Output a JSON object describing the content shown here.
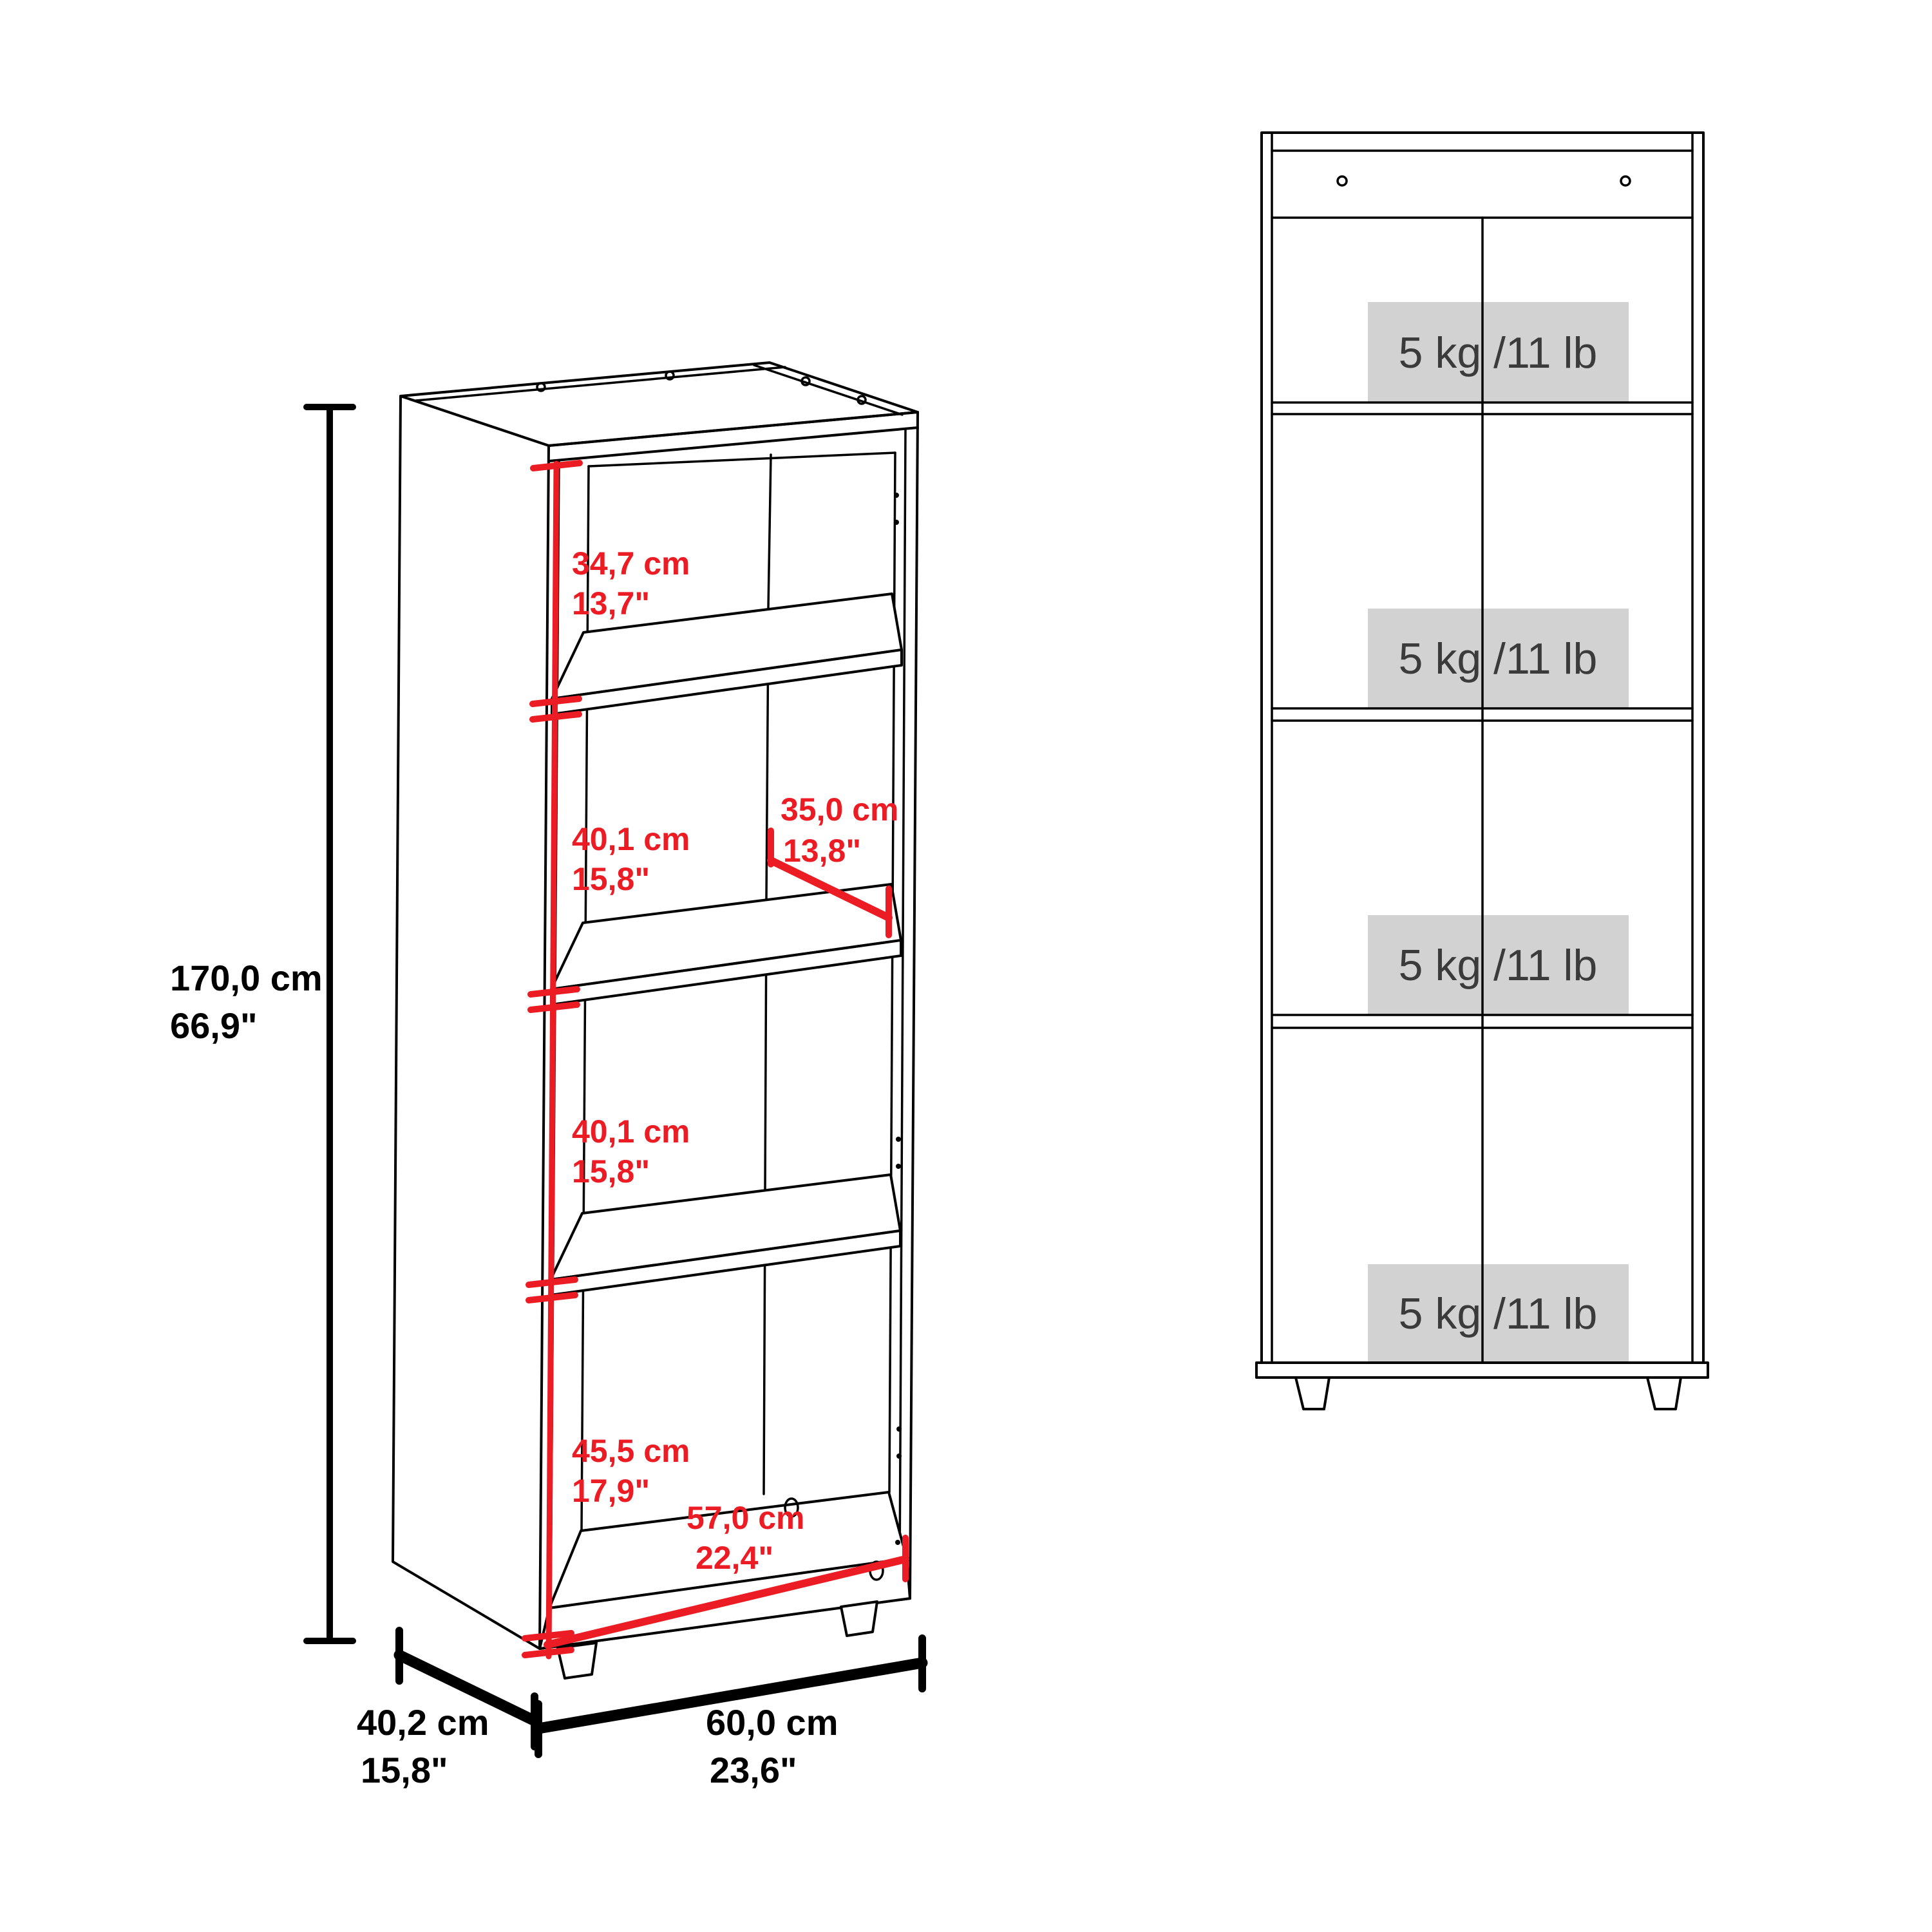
{
  "diagram": {
    "kind": "bookcase dimension diagram",
    "views": [
      "perspective",
      "front"
    ]
  },
  "colors": {
    "background": "#ffffff",
    "line": "#000000",
    "dimension_accent": "#ec1c24",
    "load_badge_bg": "#d2d2d2",
    "load_badge_text": "#3b3b3b"
  },
  "perspective_view": {
    "overall_height": {
      "metric": "170,0 cm",
      "imperial": "66,9\""
    },
    "compartment_heights": [
      {
        "metric": "34,7 cm",
        "imperial": "13,7\""
      },
      {
        "metric": "40,1 cm",
        "imperial": "15,8\""
      },
      {
        "metric": "40,1 cm",
        "imperial": "15,8\""
      },
      {
        "metric": "45,5 cm",
        "imperial": "17,9\""
      }
    ],
    "shelf_depth": {
      "metric": "35,0 cm",
      "imperial": "13,8\""
    },
    "interior_width": {
      "metric": "57,0 cm",
      "imperial": "22,4\""
    },
    "base_depth": {
      "metric": "40,2 cm",
      "imperial": "15,8\""
    },
    "base_width": {
      "metric": "60,0 cm",
      "imperial": "23,6\""
    }
  },
  "front_view": {
    "shelf_load_capacities": [
      {
        "label": "5 kg /11 lb"
      },
      {
        "label": "5 kg /11 lb"
      },
      {
        "label": "5 kg /11 lb"
      },
      {
        "label": "5 kg /11 lb"
      }
    ]
  }
}
